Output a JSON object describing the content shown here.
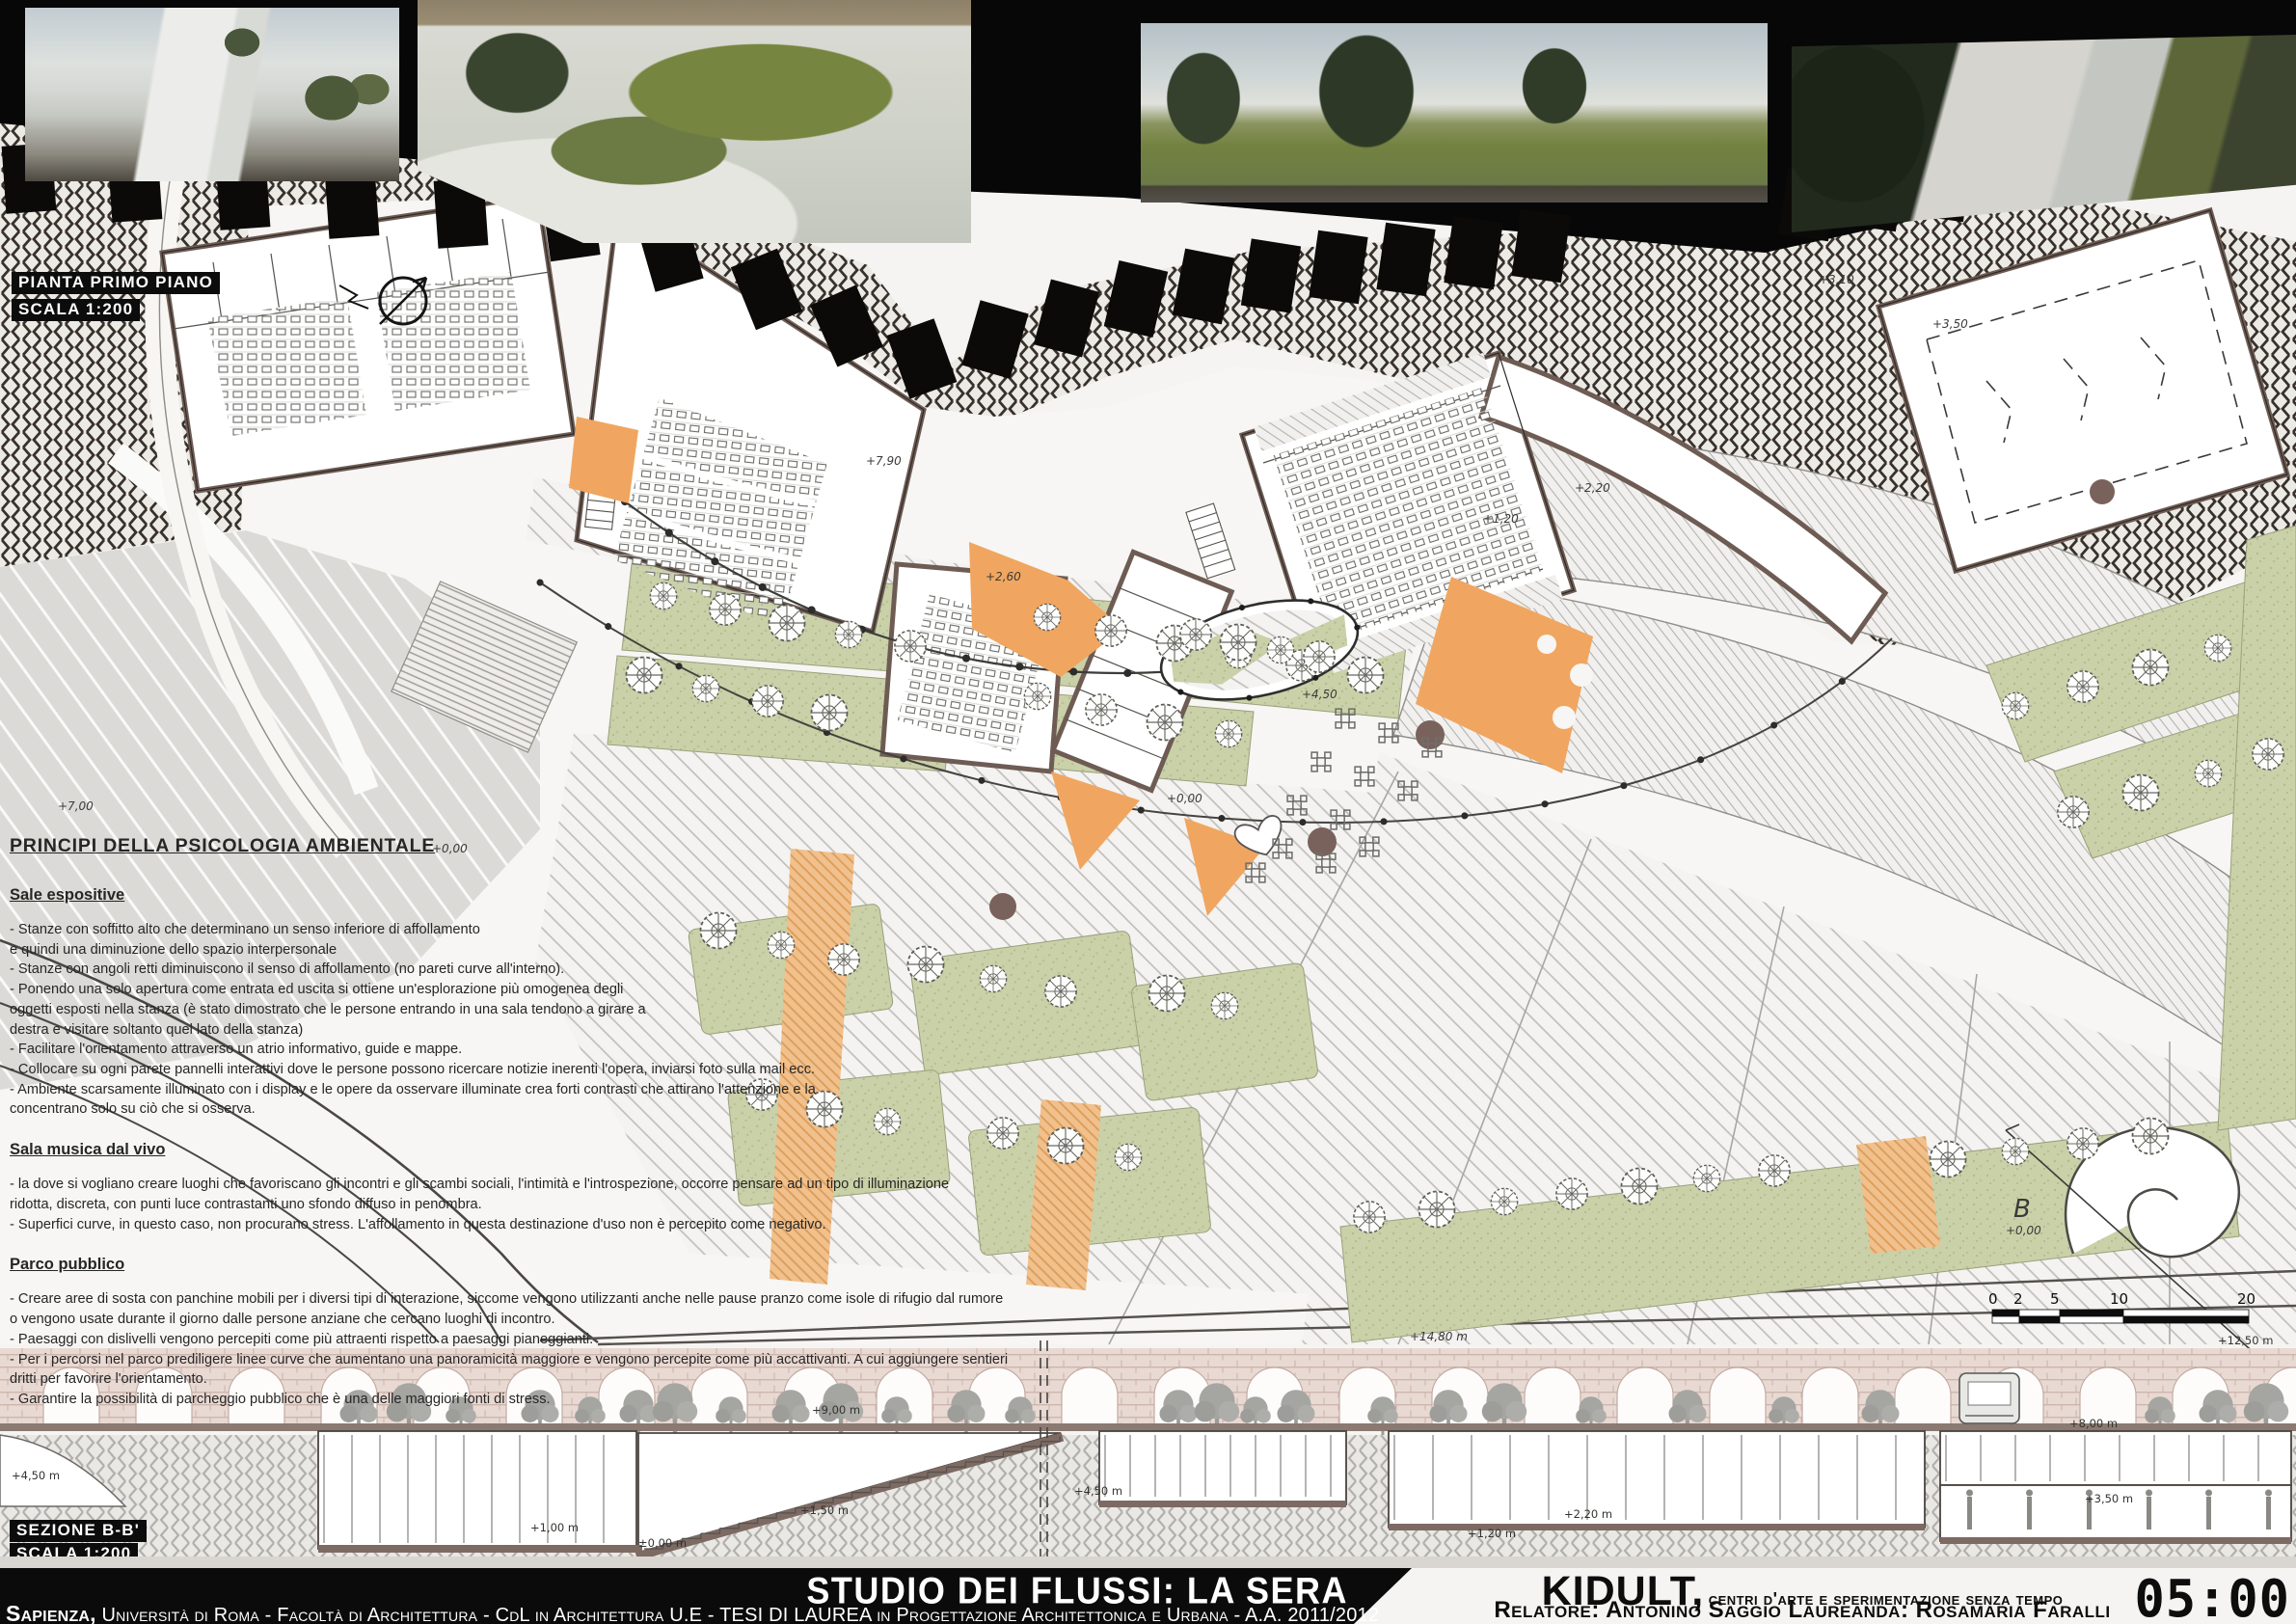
{
  "labels": {
    "plan_title": "PIANTA PRIMO PIANO",
    "plan_scale": "SCALA 1:200",
    "section_title": "SEZIONE B-B'",
    "section_scale": "SCALA 1:200",
    "section_marker": "B"
  },
  "principles": {
    "heading": "PRINCIPI DELLA PSICOLOGIA AMBIENTALE",
    "sections": [
      {
        "title": "Sale espositive",
        "body": "- Stanze con soffitto alto che determinano un senso inferiore di affollamento\ne quindi una diminuzione dello spazio interpersonale\n- Stanze con angoli retti diminuiscono il senso di affollamento (no pareti curve all'interno).\n- Ponendo una solo apertura come entrata ed uscita si ottiene un'esplorazione più omogenea degli\noggetti esposti nella stanza (è stato dimostrato che le persone entrando in una sala tendono a girare a\ndestra e visitare soltanto quel lato della stanza)\n- Facilitare l'orientamento attraverso un atrio informativo, guide e mappe.\n- Collocare su ogni parete pannelli interattivi dove le persone possono ricercare notizie inerenti l'opera, inviarsi foto sulla mail ecc.\n- Ambiente scarsamente illuminato con i display e le opere da osservare illuminate crea forti contrasti che attirano l'attenzione e la\nconcentrano solo su ciò che si osserva."
      },
      {
        "title": "Sala musica dal vivo",
        "body": "- la dove si vogliano creare luoghi che favoriscano gli incontri e gli scambi sociali, l'intimità e l'introspezione, occorre pensare ad un tipo di illuminazione\nridotta, discreta, con punti luce contrastanti uno sfondo diffuso in penombra.\n- Superfici curve, in questo caso, non procurano stress. L'affollamento in questa destinazione d'uso non è percepito come negativo."
      },
      {
        "title": "Parco pubblico",
        "body": "- Creare aree di sosta con panchine mobili per i diversi tipi di interazione, siccome vengono utilizzanti anche nelle pause pranzo come isole di rifugio dal rumore\no vengono usate durante il giorno dalle persone anziane che cercano luoghi di incontro.\n- Paesaggi con dislivelli vengono percepiti come più attraenti rispetto a paesaggi pianeggianti.\n- Per i percorsi nel parco prediligere linee curve che aumentano una panoramicità maggiore e vengono percepite come più accattivanti. A cui aggiungere sentieri\ndritti per favorire l'orientamento.\n- Garantire la possibilità di parcheggio pubblico che è una delle maggiori fonti di stress."
      }
    ]
  },
  "plan": {
    "annotations": [
      "+0,00",
      "+2,60",
      "+1,20",
      "+2,20",
      "+4,50",
      "+0,00",
      "+3,10",
      "+3,50",
      "+0,00",
      "+7,90",
      "+14,80 m",
      "+7,00"
    ]
  },
  "section": {
    "levels": [
      "+9,00 m",
      "+12,50 m",
      "+8,00 m",
      "+4,50 m",
      "+4,50 m",
      "+2,20 m",
      "+1,20 m",
      "+1,50 m",
      "+1,00 m",
      "±0,00 m",
      "+3,50 m"
    ]
  },
  "scalebar": {
    "labels": [
      "0",
      "2",
      "5",
      "10",
      "20"
    ]
  },
  "footer": {
    "project_title": "STUDIO DEI FLUSSI: LA SERA",
    "university_prefix": "Sapienza,",
    "university_rest": " Università di Roma - Facoltà di Architettura - CdL in Architettura U.E - TESI DI LAUREA in Progettazione Architettonica e Urbana - A.A. 2011/2012",
    "work_title": "KIDULT,",
    "work_subtitle": "centri d'arte e sperimentazione senza tempo",
    "credits": "Relatore: Antonino Saggio Laureanda: Rosamaria Faralli",
    "time": "05:00"
  },
  "colors": {
    "accent_orange": "#f0a660",
    "wall_brown": "#6e5c54",
    "park_green": "#cad1a9",
    "band_dark": "#37302b",
    "footer_black": "#0b0b0b"
  }
}
